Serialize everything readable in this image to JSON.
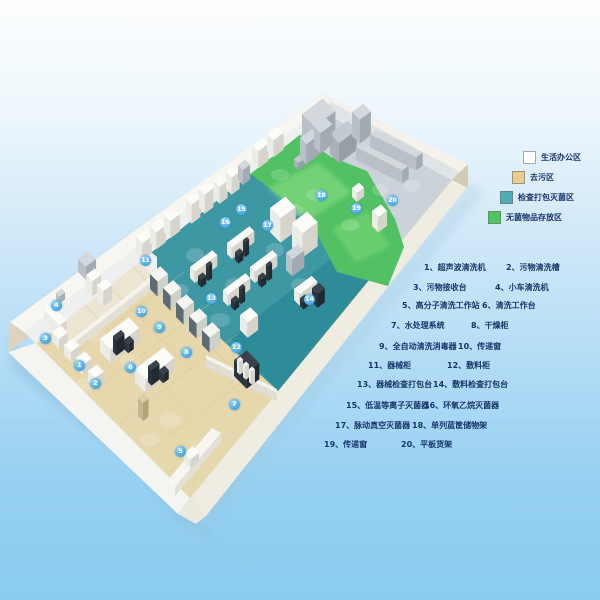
{
  "legend": {
    "items": [
      {
        "label": "生活办公区",
        "color": "#ffffff"
      },
      {
        "label": "去污区",
        "color": "#e9cd90"
      },
      {
        "label": "检查打包灭菌区",
        "color": "#52abb5"
      },
      {
        "label": "无菌物品存放区",
        "color": "#4ec463"
      }
    ]
  },
  "equipment_list": {
    "lines": [
      {
        "left": "1、超声波清洗机",
        "right": "2、污物清洗槽"
      },
      {
        "left": "3、污物接收台",
        "right": "4、小车清洗机"
      },
      {
        "left": "5、高分子清洗工作站",
        "right": "6、清洗工作台"
      },
      {
        "left": "7、水处理系统",
        "right": "8、干燥柜"
      },
      {
        "left": "9、全自动清洗消毒器",
        "right": "10、传递窗"
      },
      {
        "left": "11、器械柜",
        "right": "12、敷料柜"
      },
      {
        "left": "13、器械检查打包台",
        "right": "14、敷料检查打包台"
      },
      {
        "left": "15、低温等离子灭菌器",
        "right": "16、环氧乙烷灭菌器"
      },
      {
        "left": "17、脉动真空灭菌器",
        "right": "18、单列蓝筐储物架"
      },
      {
        "left": "19、传递窗",
        "right": "20、平板货架"
      }
    ]
  },
  "markers": [
    {
      "n": "1",
      "x": 80,
      "y": 366
    },
    {
      "n": "2",
      "x": 96,
      "y": 384
    },
    {
      "n": "3",
      "x": 46,
      "y": 339
    },
    {
      "n": "4",
      "x": 57,
      "y": 306
    },
    {
      "n": "5",
      "x": 181,
      "y": 452
    },
    {
      "n": "6",
      "x": 131,
      "y": 368
    },
    {
      "n": "7",
      "x": 235,
      "y": 405
    },
    {
      "n": "8",
      "x": 187,
      "y": 353
    },
    {
      "n": "9",
      "x": 160,
      "y": 328
    },
    {
      "n": "10",
      "x": 142,
      "y": 312
    },
    {
      "n": "11",
      "x": 146,
      "y": 261
    },
    {
      "n": "12",
      "x": 237,
      "y": 348
    },
    {
      "n": "13",
      "x": 212,
      "y": 299
    },
    {
      "n": "14",
      "x": 310,
      "y": 300
    },
    {
      "n": "15",
      "x": 242,
      "y": 210
    },
    {
      "n": "16",
      "x": 226,
      "y": 223
    },
    {
      "n": "17",
      "x": 268,
      "y": 226
    },
    {
      "n": "18",
      "x": 322,
      "y": 196
    },
    {
      "n": "19",
      "x": 357,
      "y": 209
    },
    {
      "n": "20",
      "x": 393,
      "y": 201
    }
  ],
  "colors": {
    "zone_decontamination": "#e7d7ad",
    "zone_inspection_pack_sterilize": "#3e98a3",
    "zone_sterile_storage": "#52c163",
    "zone_office_corridor": "#ebe5d2",
    "zone_machinery_grey": "#ccd3d8",
    "marker_blue": "#4aa6dd",
    "text_navy": "#17356a"
  }
}
